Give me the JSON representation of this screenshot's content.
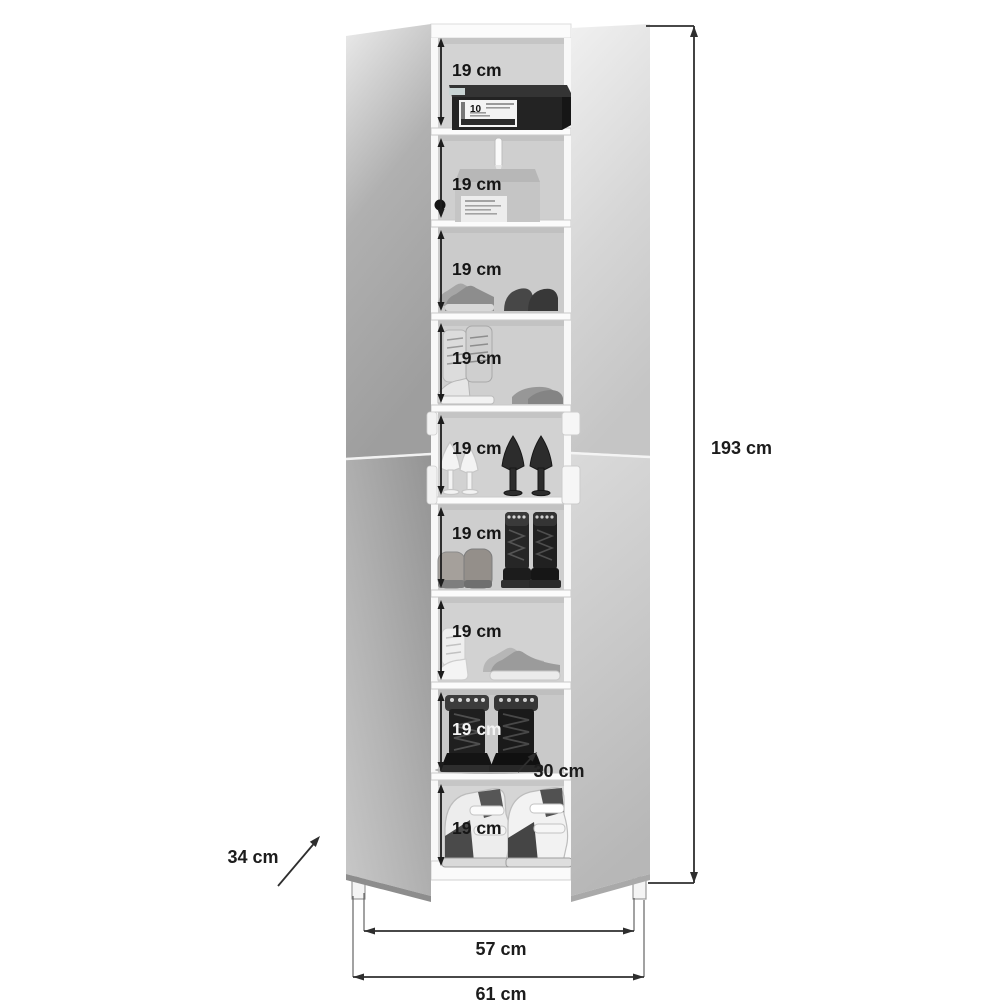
{
  "figure": {
    "type": "furniture-dimension-diagram",
    "subject": "Tall mirrored shoe cabinet with both doors open showing nine shelves"
  },
  "shelves": [
    {
      "label": "19 cm",
      "contents": "black shoe box",
      "box_label": "10"
    },
    {
      "label": "19 cm",
      "contents": "gray cardboard box with hanging strap"
    },
    {
      "label": "19 cm",
      "contents": "gray sneaker and dark flats"
    },
    {
      "label": "19 cm",
      "contents": "light high-top sneakers and gray flats"
    },
    {
      "label": "19 cm",
      "contents": "white and black high-heel pumps"
    },
    {
      "label": "19 cm",
      "contents": "gray shoes and black studded boots"
    },
    {
      "label": "19 cm",
      "contents": "white high-top and gray sneakers"
    },
    {
      "label": "19 cm",
      "contents": "black combat boots"
    },
    {
      "label": "19 cm",
      "contents": "black and white wedge sandals"
    }
  ],
  "dimensions": {
    "total_height": "193 cm",
    "inner_width": "57 cm",
    "outer_width": "61 cm",
    "side_depth": "34 cm",
    "shelf_depth": "30 cm"
  },
  "colors": {
    "background": "#ffffff",
    "dimension_line": "#2e2e2e",
    "label_text": "#161616",
    "door_gray": "#aeaeae",
    "interior_gray": "#cfcfcf",
    "frame_white": "#fafafa"
  }
}
